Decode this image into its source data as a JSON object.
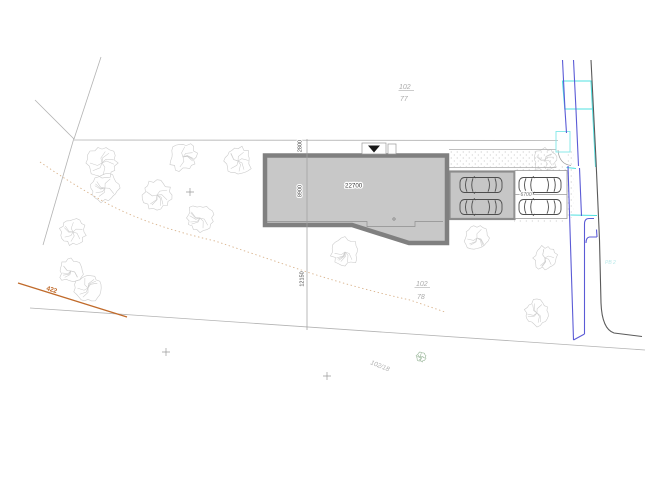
{
  "drawing": {
    "type": "cadastral-site-plan",
    "parcels": {
      "north": {
        "number": "102",
        "sub_number": "77"
      },
      "south": {
        "number": "102",
        "sub_number": "78"
      },
      "southwest": {
        "number": "102/18"
      }
    },
    "contour": {
      "elevation_label": "422"
    },
    "road": {
      "note": "PB 2"
    },
    "dimensions": {
      "building_width": "22700",
      "building_depth": "8900",
      "front_setback": "2800",
      "south_distance": "12150",
      "parking_depth": "6700"
    },
    "colors": {
      "building_fill": "#c8c8c8",
      "building_outline": "#808080",
      "garage_fill": "#c6c6c6",
      "road_blue": "#5b5bd6",
      "road_cyan": "#4fe0e0",
      "road_edge_gray": "#5a5a5a",
      "contour_orange": "#c06a2a",
      "contour_tan": "#d9b38c",
      "boundary_gray": "#b3b3b3",
      "tree_gray": "#cccccc",
      "bush_green": "#98b598"
    },
    "counts": {
      "cars": 4,
      "trees": 14,
      "survey_crosses": 3
    }
  }
}
